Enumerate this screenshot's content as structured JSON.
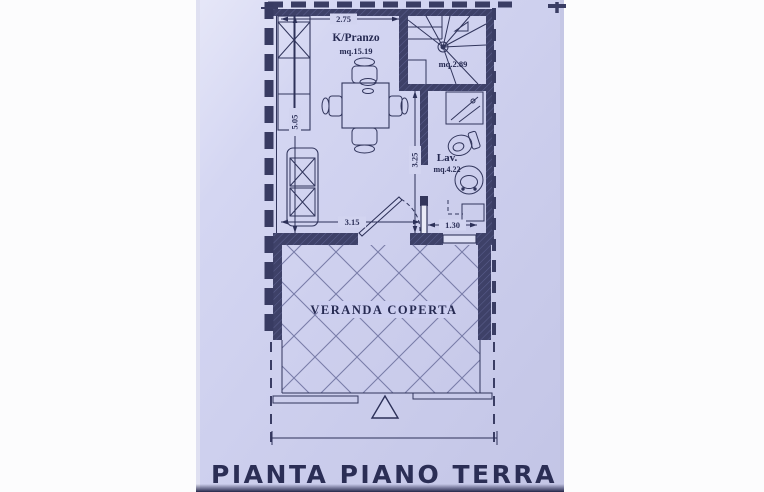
{
  "document": {
    "kind": "scanned floor plan photo",
    "title": "PIANTA PIANO TERRA"
  },
  "rooms": {
    "kitchen": {
      "name": "K/Pranzo",
      "area": "mq.15.19"
    },
    "stairwell": {
      "area": "mq.2.89"
    },
    "bathroom": {
      "name": "Lav.",
      "area": "mq.4.22"
    },
    "veranda": {
      "name": "VERANDA COPERTA"
    }
  },
  "dimensions": {
    "kitchen_width_top": "2.75",
    "kitchen_depth_left": "5.05",
    "kitchen_width_bottom": "3.15",
    "bathroom_depth": "3.25",
    "veranda_door_width": "1.30"
  },
  "symbols": {
    "entrance_marker": "triangle-arrow",
    "stair": "winder-staircase",
    "furniture": [
      "kitchen-counter",
      "sofa",
      "dining-table-with-chairs",
      "shower",
      "toilet",
      "washbasin"
    ]
  },
  "colors": {
    "paper": "#cfd1ef",
    "ink": "#2c2f57",
    "wall_fill": "#3e4168",
    "tile_line": "#797da9"
  }
}
